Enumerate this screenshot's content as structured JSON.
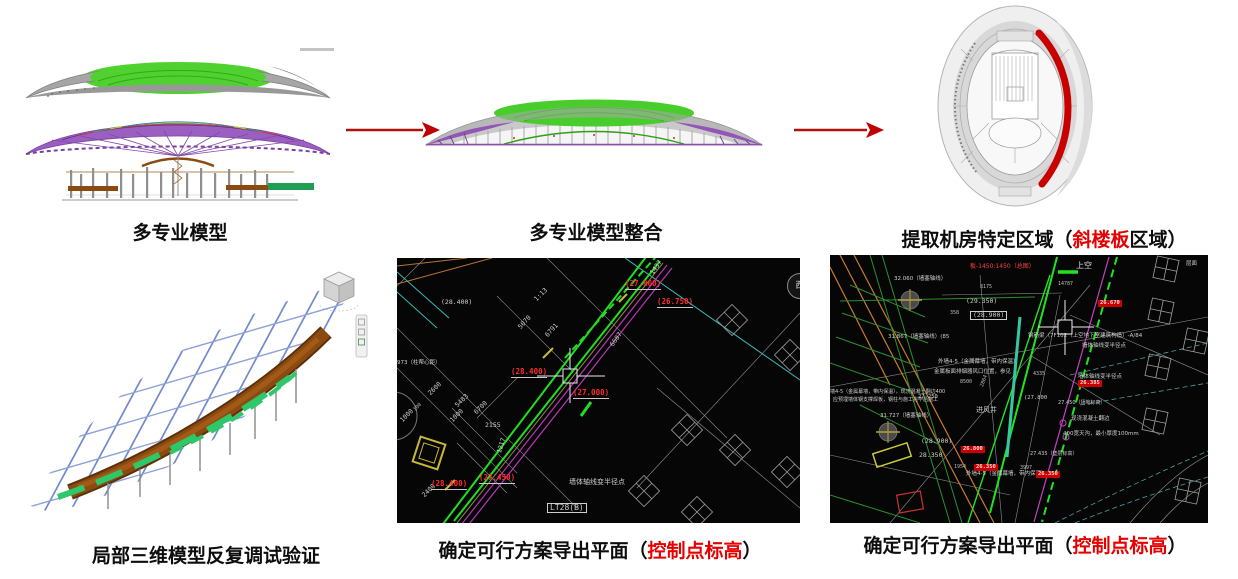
{
  "captions": {
    "top1": "多专业模型",
    "top2": "多专业模型整合",
    "top3_pre": "提取机房特定区域（",
    "top3_red": "斜楼板",
    "top3_post": "区域）",
    "bottom1": "局部三维模型反复调试验证",
    "bottom2_pre": "确定可行方案导出平面（",
    "bottom2_red": "控制点标高",
    "bottom2_post": "）",
    "bottom3_pre": "确定可行方案导出平面（",
    "bottom3_red": "控制点标高",
    "bottom3_post": "）"
  },
  "colors": {
    "caption_red": "#e60000",
    "arrow_red": "#b01010",
    "cad_green": "#22dd22",
    "cad_magenta": "#b836b8",
    "cad_red_label": "#ff2d2d",
    "highlight_crescent": "#c80000"
  },
  "cad_mid": {
    "compass": "西",
    "box_label": "LT28(B)",
    "red_labels": [
      "(27.800)",
      "(26.750)",
      "(28.400)",
      "(27.000)",
      "(28.400)",
      "(27.450)"
    ],
    "white_labels": [
      "(28.400)",
      "1:13",
      "1437",
      "5070",
      "6791",
      "6607",
      "973（柱帮心距）",
      "2600",
      "5483",
      "6700",
      "100",
      "1000",
      "1000",
      "2155",
      "1217",
      "2400",
      "墙体轴线变半径点"
    ]
  },
  "cad_right": {
    "red_note": "板-1450:1450（总图）",
    "badges": [
      "26.670",
      "26.385",
      "26.800",
      "26.350",
      "26.350"
    ],
    "labels": [
      "上空",
      "层面",
      "32.060（墙塞轴线）",
      "8175",
      "14787",
      "(29.350)",
      "(28.900)",
      "358",
      "31.867（墙塞轴线）(85",
      "钢筋梁（7F102（上空地下室建筑构造）-A/84",
      "墙体轴线变半径点",
      "外墙4-5（金属幕墙，带内保温）",
      "金属板面排烟器风口位置，参见",
      "8500",
      "2864",
      "墙4-5（金属幕墙，带内保温），现浇混凝土翻边400",
      "应预埋墙体钢支撑焊板，钢柱与施工完毕后施工",
      "墙体轴线变半径点",
      "31.727（墙塞轴线）",
      "27.250",
      "(27.800",
      "27.450（场地标高）",
      "进风井",
      "现浇混凝土翻边",
      "400宽天沟，最小厚度100mm",
      "(28.900)",
      "28.350",
      "27.435（垫层标高）",
      "外墙4-5（金属幕墙，带内保温）",
      "1954",
      "3997",
      "4335"
    ]
  }
}
